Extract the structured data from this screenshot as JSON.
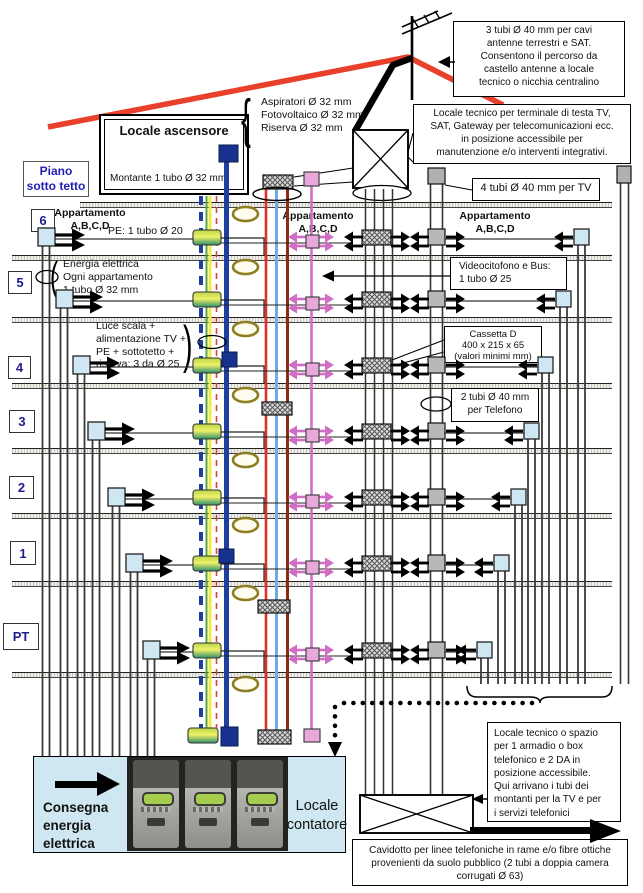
{
  "colors": {
    "roof_red": "#e8402a",
    "pink_riser": "#cf6ec4",
    "blue_riser": "#1e3fa0",
    "meter_room_bg": "#cfe7f0"
  },
  "piano_label": "Piano\nsotto tetto",
  "elevator": {
    "title": "Locale ascensore",
    "subtitle": "Montante 1 tubo Ø 32 mm"
  },
  "floors": [
    "6",
    "5",
    "4",
    "3",
    "2",
    "1",
    "PT"
  ],
  "boxes": {
    "tubi3": "3 tubi Ø 40 mm per cavi\nantenne terrestri e SAT.\nConsentono il percorso da\ncastello antenne a locale\ntecnico o nicchia centralino",
    "locale_testa": "Locale tecnico  per terminale di testa TV,\nSAT, Gateway per telecomunicazioni ecc.\nin posizione accessibile per\nmanutenzione e/o interventi integrativi.",
    "tubi4_tv": "4 tubi Ø 40 mm per TV",
    "videocitofono": "Videocitofono e Bus:\n1 tubo Ø 25",
    "cassetta": "Cassetta D\n400 x 215 x 65\n(valori minimi mm)",
    "tubi2_tel": "2 tubi Ø 40 mm\nper Telefono",
    "locale_spazio": "Locale tecnico o spazio\nper 1 armadio o box\ntelefonico e 2 DA in\nposizione accessibile.\nQui arrivano  i tubi dei\nmontanti per la TV e per\ni servizi telefonici",
    "cavidotto": "Cavidotto per linee  telefoniche in rame e/o fibre ottiche\nprovenienti da suolo pubblico (2  tubi a doppia camera\ncorrugati Ø 63)"
  },
  "labels": {
    "apartment": "Appartamento\nA,B,C,D",
    "pe": "PE: 1 tubo Ø 20",
    "energia": "Energia elettrica\nOgni appartamento\n1 tubo Ø 32 mm",
    "luce": "Luce scala +\nalimentazione TV +\nPE + sottotetto +\nriserva: 3 da Ø 25",
    "aspiratori": "Aspiratori Ø 32 mm\nFotovoltaico Ø 32 mm\nRiserva Ø 32 mm",
    "consegna": "Consegna\nenergia\nelettrica",
    "contatore": "Locale\ncontatore"
  },
  "glyphs": {
    "open_curly": "{",
    "open_paren": "(",
    "close_paren": ")"
  }
}
